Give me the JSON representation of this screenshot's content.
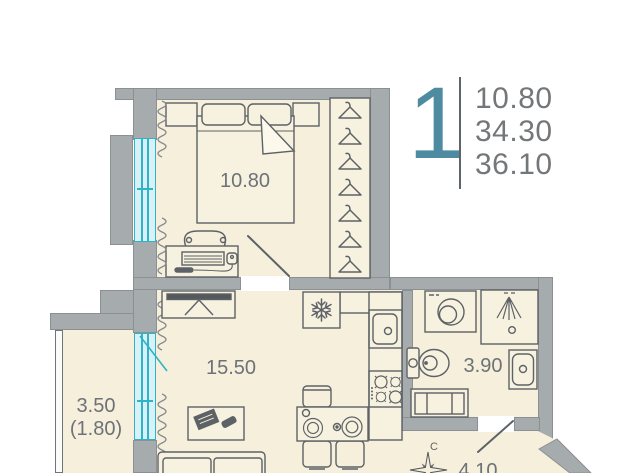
{
  "info": {
    "rooms_count": "1",
    "areas": [
      "10.80",
      "34.30",
      "36.10"
    ]
  },
  "rooms": {
    "bedroom": "10.80",
    "living": "15.50",
    "bathroom": "3.90",
    "balcony": "3.50",
    "balcony_reduced": "(1.80)",
    "hallway": "4.10"
  },
  "compass": {
    "north": "C"
  },
  "colors": {
    "wall": "#a6abae",
    "floor": "#f5efdc",
    "furniture_fill": "#f7f1df",
    "outline": "#5d6266",
    "window_frame": "#2fb3c8",
    "window_fill": "#d8f1f7",
    "accent": "#4e8ba1",
    "info_text": "#747779",
    "label_text": "#6d7277"
  }
}
